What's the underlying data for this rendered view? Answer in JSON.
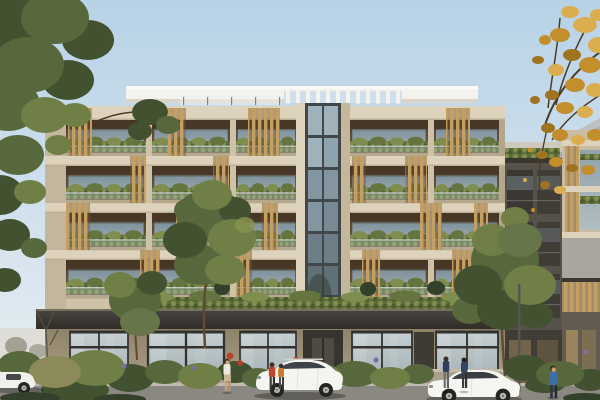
{
  "meta": {
    "domain": "architectural-rendering",
    "description": "Street-level rendering of a modern five-storey apartment building: limestone facade, staggered timber-slat balcony screens, planted glass balustrades, white rooftop slab with pergola, full-height glazed stair core, dark annex wing with green roof at right, leafy street trees (one golden autumn tree top-right), low garden wall, parked white cars and pedestrians under a clear pale-blue sky.",
    "image_size": {
      "width": 600,
      "height": 400
    }
  },
  "colors": {
    "sky_top": "#b7d2e6",
    "sky_bottom": "#e9eff3",
    "haze": "#dcd8cf",
    "roof_white": "#f3f2ed",
    "roof_shadow": "#d8d4c9",
    "pergola_sky": "#cfe0ec",
    "stone": "#cec2a9",
    "stone_light": "#ddd3bc",
    "stone_dark": "#b3a68b",
    "interior_top": "#4e3d2c",
    "interior_mid": "#74604a",
    "glass_top": "#8ba0ab",
    "glass_bottom": "#adbdc4",
    "gwin_top": "#c6cfd1",
    "gwin_bottom": "#9aa8ad",
    "wood": "#c59f62",
    "wood_gap": "#6f5432",
    "hedge": "#5d6d3a",
    "hedge_light": "#7f8d4f",
    "tree_dark": "#42512f",
    "tree_mid": "#57683c",
    "tree_light": "#6f7f46",
    "tree_pale": "#87934f",
    "trunk": "#5d4b34",
    "branch": "#4a3b28",
    "autumn_1": "#c28f2c",
    "autumn_2": "#daad4f",
    "autumn_3": "#9f7420",
    "canopy_top": "#474440",
    "canopy_bottom": "#302d29",
    "ground_top": "#8e8269",
    "ground_bottom": "#b3a88f",
    "tower_frame": "#42474a",
    "pane_top": "#9fb2bc",
    "pane_mid": "#8295a0",
    "pane_low": "#5f7077",
    "dark_wing": "#56524a",
    "dark_wing_deep": "#3a3731",
    "bg_top": "#aab0b3",
    "bg_bottom": "#8e9498",
    "right_strip": "#c8bca3",
    "road": "#8b8882",
    "curb": "#c0bab0",
    "wall": "#a89f8d",
    "wall_cap": "#c6bda9",
    "tire": "#242422",
    "rim": "#b5b5b1",
    "flower_red": "#b8402e",
    "flower_purple": "#7c6fa0"
  },
  "building": {
    "balcony_floors": 4,
    "ground_floor": "glazed retail frontage with lobby entry",
    "roof": "white slab with open pergola and glass railing",
    "stair_core": "full-height glazed curtain wall",
    "materials": [
      "limestone",
      "timber slats",
      "glass balustrades",
      "planted hedges"
    ]
  },
  "scene": {
    "cars": [
      {
        "label": "parked-car-left-partial",
        "body": "#f1f0ec"
      },
      {
        "label": "white-suv-center",
        "body": "#f4f4f1"
      },
      {
        "label": "white-hatchback-right",
        "body": "#f5f5f2"
      }
    ],
    "people": [
      {
        "label": "walker-white-top",
        "shirt": "#ebe8e0",
        "legs": "#c8a47e"
      },
      {
        "label": "pedestrian-red-top",
        "shirt": "#bf4730",
        "legs": "#3a3a3a"
      },
      {
        "label": "pedestrian-orange-top",
        "shirt": "#cd7a2e",
        "legs": "#4a4a48"
      },
      {
        "label": "pedestrian-navy",
        "shirt": "#2e3f5c",
        "legs": "#707070"
      },
      {
        "label": "pedestrian-dark-blue",
        "shirt": "#35455f",
        "legs": "#3c3c3a"
      },
      {
        "label": "walker-blue-shirt",
        "shirt": "#3f6ea8",
        "legs": "#2f3440"
      }
    ],
    "trees": [
      {
        "label": "street-tree-left-large",
        "tone": "green"
      },
      {
        "label": "street-tree-mid-left",
        "tone": "green"
      },
      {
        "label": "street-tree-center",
        "tone": "green"
      },
      {
        "label": "street-tree-right",
        "tone": "green"
      },
      {
        "label": "autumn-tree-top-right",
        "tone": "golden"
      }
    ]
  }
}
